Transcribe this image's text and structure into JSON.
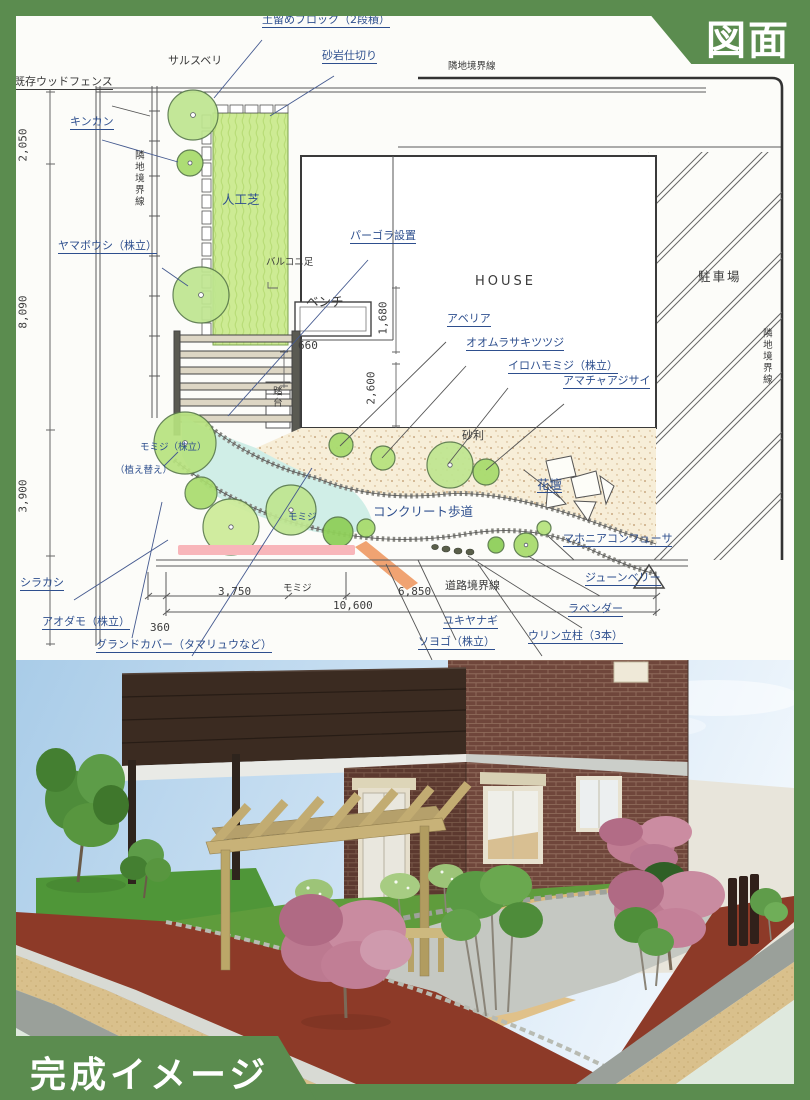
{
  "badges": {
    "plan": "図面",
    "render": "完成イメージ"
  },
  "colors": {
    "badge_green": "#5b8c4f",
    "plan_blue": "#2e4f8e",
    "plan_black": "#3a3a3a",
    "lawn_green": "#cdeb94",
    "tree_green": "#c2e88e",
    "highlight_pink": "#f8b6ba",
    "highlight_orange": "#f0a372"
  },
  "plan": {
    "labels": [
      {
        "text": "土留めブロック（2段積）"
      },
      {
        "text": "サルスベリ"
      },
      {
        "text": "砂岩仕切り"
      },
      {
        "text": "隣地境界線"
      },
      {
        "text": "既存ウッドフェンス"
      },
      {
        "text": "キンカン"
      },
      {
        "text": "2,050"
      },
      {
        "text": "隣地境界線"
      },
      {
        "text": "人工芝"
      },
      {
        "text": "ヤマボウシ（株立）"
      },
      {
        "text": "バルコニ足"
      },
      {
        "text": "パーゴラ設置"
      },
      {
        "text": "HOUSE"
      },
      {
        "text": "ベンチ"
      },
      {
        "text": "1,680"
      },
      {
        "text": "8,090"
      },
      {
        "text": "アベリア"
      },
      {
        "text": "オオムラサキツツジ"
      },
      {
        "text": "イロハモミジ（株立）"
      },
      {
        "text": "アマチャアジサイ"
      },
      {
        "text": "駐車場"
      },
      {
        "text": "隣地境界線"
      },
      {
        "text": "660"
      },
      {
        "text": "2,600"
      },
      {
        "text": "踏台"
      },
      {
        "text": "砂利"
      },
      {
        "text": "モミジ（株立）"
      },
      {
        "text": "（植え替え）"
      },
      {
        "text": "3,900"
      },
      {
        "text": "花壇"
      },
      {
        "text": "コンクリート歩道"
      },
      {
        "text": "モミジ"
      },
      {
        "text": "マホニアコンフューサ"
      },
      {
        "text": "シラカシ"
      },
      {
        "text": "ジューンベリー"
      },
      {
        "text": "道路境界線"
      },
      {
        "text": "3,750"
      },
      {
        "text": "モミジ"
      },
      {
        "text": "6,850"
      },
      {
        "text": "10,600"
      },
      {
        "text": "ラベンダー"
      },
      {
        "text": "アオダモ（株立）"
      },
      {
        "text": "360"
      },
      {
        "text": "ユキヤナギ"
      },
      {
        "text": "ソヨゴ（株立）"
      },
      {
        "text": "ウリン立柱（3本）"
      },
      {
        "text": "グランドカバー（タマリュウなど）"
      }
    ]
  }
}
